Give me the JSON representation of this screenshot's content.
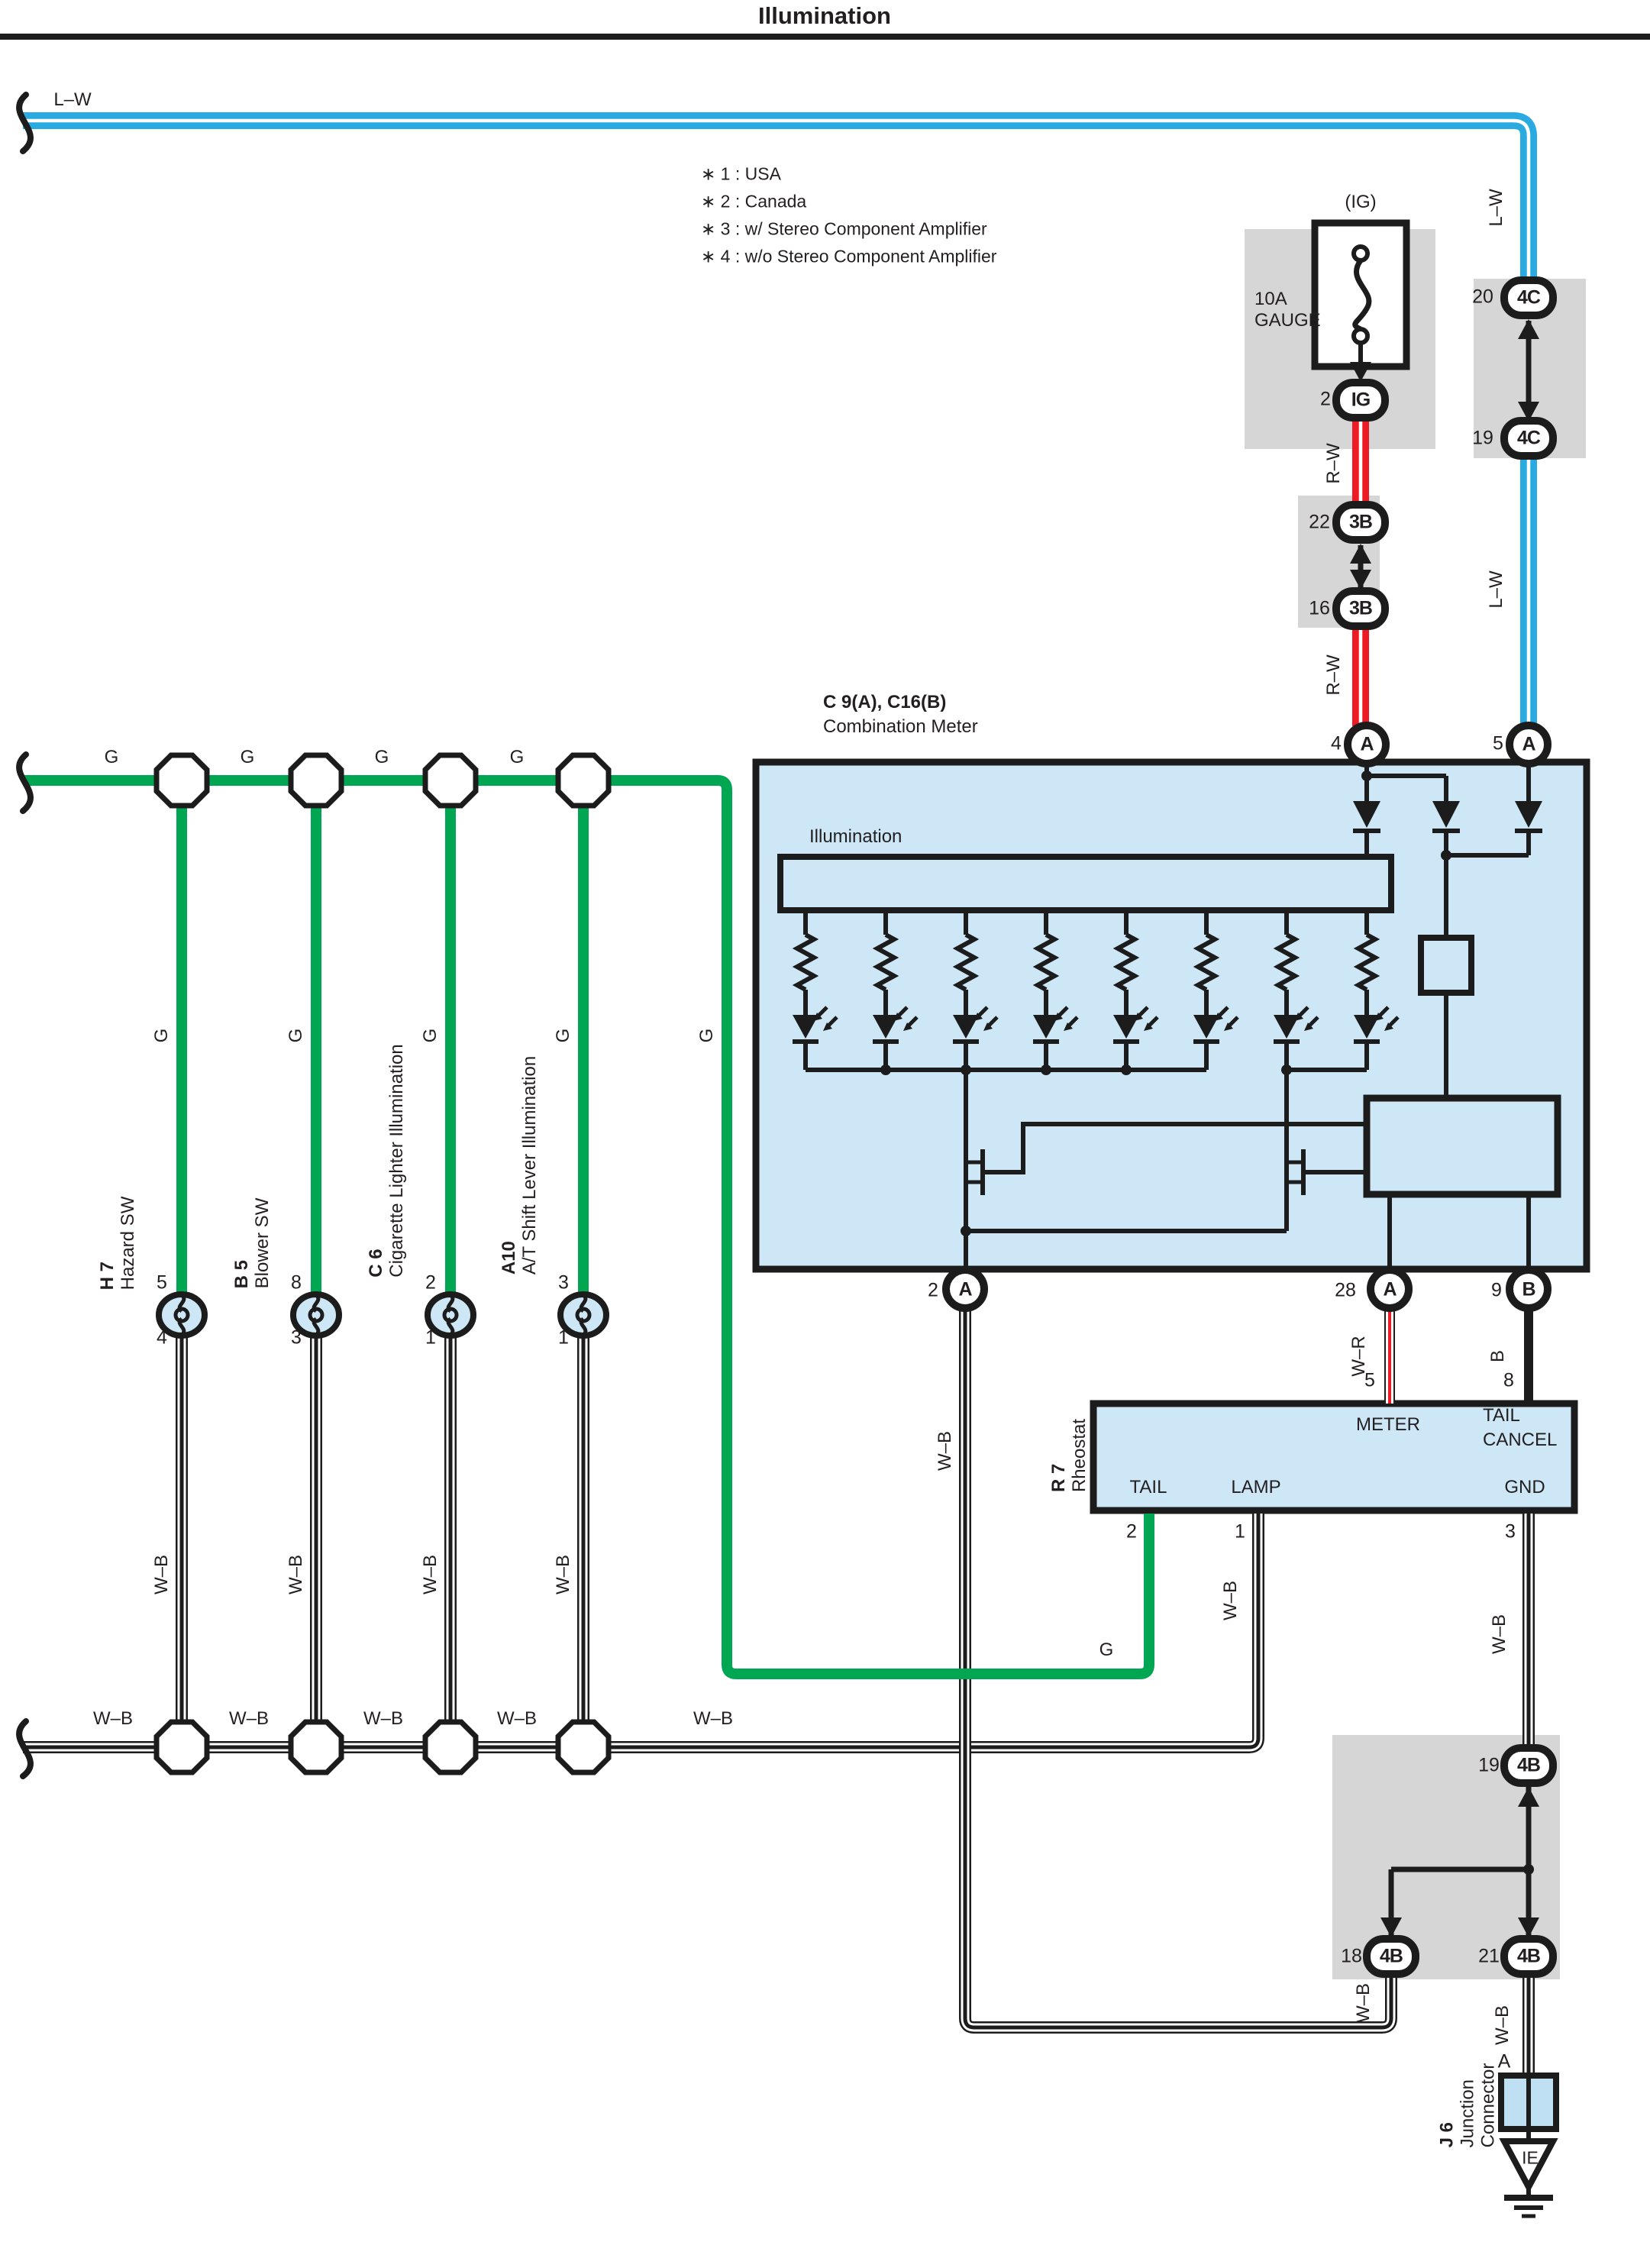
{
  "title": "Illumination",
  "notes": [
    "∗ 1 : USA",
    "∗ 2 : Canada",
    "∗ 3 : w/ Stereo Component Amplifier",
    "∗ 4 : w/o Stereo Component Amplifier"
  ],
  "fuse": {
    "label1": "10A",
    "label2": "GAUGE",
    "circuit": "(IG)",
    "connector": "IG"
  },
  "wire": {
    "lw": "L–W",
    "rw": "R–W",
    "wr": "W–R",
    "wb": "W–B",
    "g": "G",
    "b": "B"
  },
  "conn": {
    "a": "A",
    "b": "B",
    "c3b": "3B",
    "c4c": "4C",
    "c4b": "4B"
  },
  "pins": {
    "p1": "1",
    "p2": "2",
    "p3": "3",
    "p4": "4",
    "p5": "5",
    "p8": "8",
    "p9": "9",
    "p16": "16",
    "p18": "18",
    "p19": "19",
    "p20": "20",
    "p21": "21",
    "p22": "22",
    "p28": "28"
  },
  "meter": {
    "ref": "C 9(A), C16(B)",
    "name": "Combination Meter",
    "section": "Illumination"
  },
  "rheo": {
    "ref": "R 7",
    "name": "Rheostat",
    "meter": "METER",
    "tail_cancel1": "TAIL",
    "tail_cancel2": "CANCEL",
    "tail": "TAIL",
    "lamp": "LAMP",
    "gnd": "GND"
  },
  "sw": [
    {
      "ref": "H 7",
      "name": "Hazard SW",
      "pin_top": "5",
      "pin_bottom": "4"
    },
    {
      "ref": "B 5",
      "name": "Blower SW",
      "pin_top": "8",
      "pin_bottom": "3"
    },
    {
      "ref": "C 6",
      "name": "Cigarette Lighter Illumination",
      "pin_top": "2",
      "pin_bottom": "1"
    },
    {
      "ref": "A10",
      "name": "A/T Shift Lever Illumination",
      "pin_top": "3",
      "pin_bottom": "1"
    }
  ],
  "j6": {
    "ref": "J 6",
    "line1": "Junction",
    "line2": "Connector",
    "pin": "A",
    "ground": "IE"
  }
}
